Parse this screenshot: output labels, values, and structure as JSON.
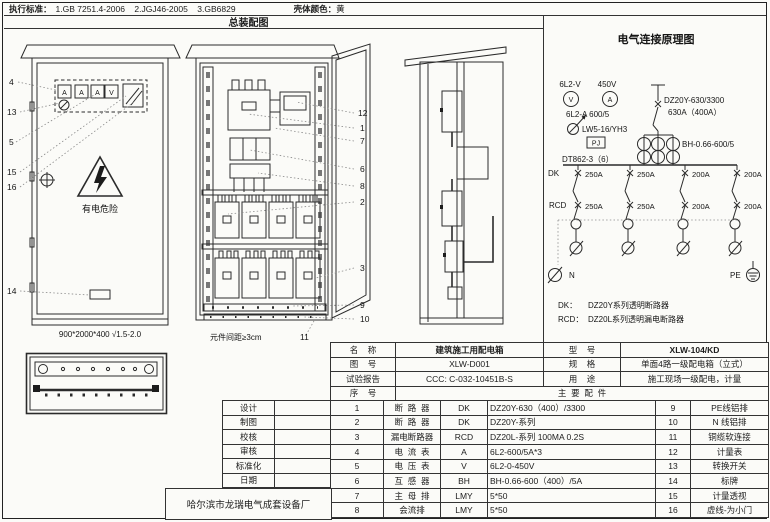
{
  "header": {
    "standards_label": "执行标准：",
    "standards": "1.GB 7251.4-2006    2.JGJ46-2005    3.GB6829",
    "color_label": "壳体颜色：",
    "color_value": "黄",
    "assembly_title": "总装配图"
  },
  "front_view": {
    "meters": [
      "A",
      "A",
      "A",
      "V"
    ],
    "warning": "有电危险",
    "dimension": "900*2000*400 √1.5-2.0",
    "callouts": [
      "4",
      "13",
      "5",
      "15",
      "16",
      "14"
    ]
  },
  "internal_view": {
    "callouts": [
      "12",
      "1",
      "7",
      "6",
      "8",
      "2",
      "3",
      "9",
      "10"
    ],
    "callout_11": "11",
    "note": "元件间距≥3cm"
  },
  "schematic": {
    "title": "电气连接原理图",
    "voltmeter_top": "6L2-V",
    "voltage_top": "450V",
    "v_symbol": "V",
    "a_symbol": "A",
    "ammeter_label": "6L2-A 600/5",
    "switch_label": "LW5-16/YH3",
    "pj": "PJ",
    "energy_meter": "DT862-3（6）",
    "main_breaker_model": "DZ20Y-630/3300",
    "main_breaker_rating": "630A（400A）",
    "ct_label": "BH-0.66-600/5",
    "dk": "DK",
    "rcd": "RCD",
    "dk_ratings": [
      "250A",
      "250A",
      "200A",
      "200A"
    ],
    "rcd_ratings": [
      "250A",
      "250A",
      "200A",
      "200A"
    ],
    "n": "N",
    "pe": "PE",
    "legend": [
      {
        "key": "DK：",
        "text": "DZ20Y系列透明断路器"
      },
      {
        "key": "RCD：",
        "text": "DZ20L系列透明漏电断路器"
      }
    ]
  },
  "info_table": {
    "rows": [
      {
        "l1": "名    称",
        "v1": "建筑施工用配电箱",
        "l2": "型    号",
        "v2": "XLW-104/KD"
      },
      {
        "l1": "图    号",
        "v1": "XLW-D001",
        "l2": "规    格",
        "v2": "单面4路一级配电箱（立式）"
      },
      {
        "l1": "试验报告",
        "v1": "CCC: C-032-10451B-S",
        "l2": "用    途",
        "v2": "施工现场一级配电，计量"
      }
    ],
    "seq_label": "序    号",
    "parts_label": "主  要  配  件"
  },
  "parts_table": {
    "rows": [
      {
        "no": "1",
        "name": "断  路  器",
        "code": "DK",
        "spec": "DZ20Y-630（400）/3300",
        "no2": "9",
        "name2": "PE线铝排"
      },
      {
        "no": "2",
        "name": "断  路  器",
        "code": "DK",
        "spec": "DZ20Y-系列",
        "no2": "10",
        "name2": "N 线铝排"
      },
      {
        "no": "3",
        "name": "漏电断路器",
        "code": "RCD",
        "spec": "DZ20L-系列  100MA 0.2S",
        "no2": "11",
        "name2": "铜缆软连接"
      },
      {
        "no": "4",
        "name": "电  流  表",
        "code": "A",
        "spec": "6L2-600/5A*3",
        "no2": "12",
        "name2": "计量表"
      },
      {
        "no": "5",
        "name": "电  压  表",
        "code": "V",
        "spec": "6L2-0-450V",
        "no2": "13",
        "name2": "转换开关"
      },
      {
        "no": "6",
        "name": "互  感  器",
        "code": "BH",
        "spec": "BH-0.66-600（400）/5A",
        "no2": "14",
        "name2": "标牌"
      },
      {
        "no": "7",
        "name": "主  母  排",
        "code": "LMY",
        "spec": "5*50",
        "no2": "15",
        "name2": "计量透视"
      },
      {
        "no": "8",
        "name": "会流排",
        "code": "LMY",
        "spec": "5*50",
        "no2": "16",
        "name2": "虚线-为小门"
      }
    ]
  },
  "title_block": {
    "labels": [
      "设计",
      "制图",
      "校核",
      "审核",
      "标准化",
      "日期"
    ],
    "company": "哈尔滨市龙瑞电气成套设备厂"
  }
}
